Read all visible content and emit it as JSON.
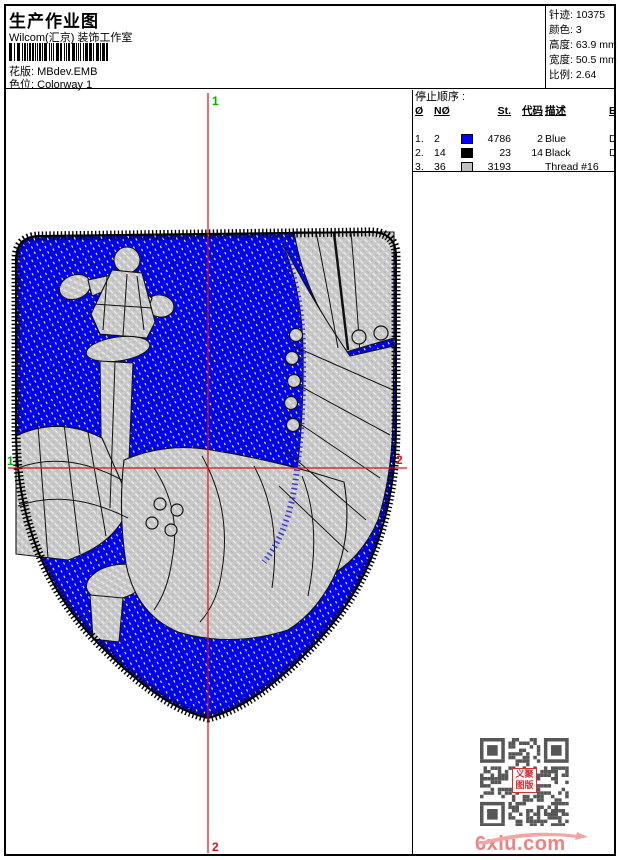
{
  "header": {
    "title": "生产作业图",
    "subtitle": "Wilcom(汇京) 装饰工作室",
    "design_label": "花版:",
    "design_value": "MBdev.EMB",
    "colorway_label": "色位:",
    "colorway_value": "Colorway 1"
  },
  "info_box": {
    "stitches_label": "针迹:",
    "stitches_value": "10375",
    "colors_label": "颜色:",
    "colors_value": "3",
    "height_label": "高度:",
    "height_value": "63.9 mm",
    "width_label": "宽度:",
    "width_value": "50.5 mm",
    "scale_label": "比例:",
    "scale_value": "2.64"
  },
  "stop_sequence": {
    "title": "停止顺序 :",
    "columns": [
      "Ø",
      "NØ",
      "St.",
      "代码",
      "描述",
      "Brand",
      "元素"
    ],
    "rows": [
      {
        "num": "1.",
        "n0": "2",
        "swatch": "#0000ff",
        "st": "4786",
        "code": "2",
        "desc": "Blue",
        "brand": "Default",
        "element": ""
      },
      {
        "num": "2.",
        "n0": "14",
        "swatch": "#000000",
        "st": "23",
        "code": "14",
        "desc": "Black",
        "brand": "Default",
        "element": ""
      },
      {
        "num": "3.",
        "n0": "36",
        "swatch": "#c0c0c0",
        "st": "3193",
        "code": "",
        "desc": "Thread #16",
        "brand": "",
        "element": ""
      },
      {
        "num": "4.",
        "n0": "14",
        "swatch": "#000000",
        "st": "2371",
        "code": "14",
        "desc": "Black",
        "brand": "Default",
        "element": ""
      }
    ]
  },
  "design": {
    "marker_top": "1",
    "marker_bottom": "2",
    "marker_left": "1",
    "marker_right": "2",
    "colors": {
      "stitch_blue": "#0202e8",
      "object_gray": "#c9c9c9",
      "border_black": "#000000",
      "crosshair_red": "#e01010",
      "marker_green": "#00b400"
    }
  },
  "watermark": {
    "site": "6xiu.com",
    "site_color": "#ef8181",
    "stamp_text_line1": "义聚",
    "stamp_text_line2": "图版"
  }
}
